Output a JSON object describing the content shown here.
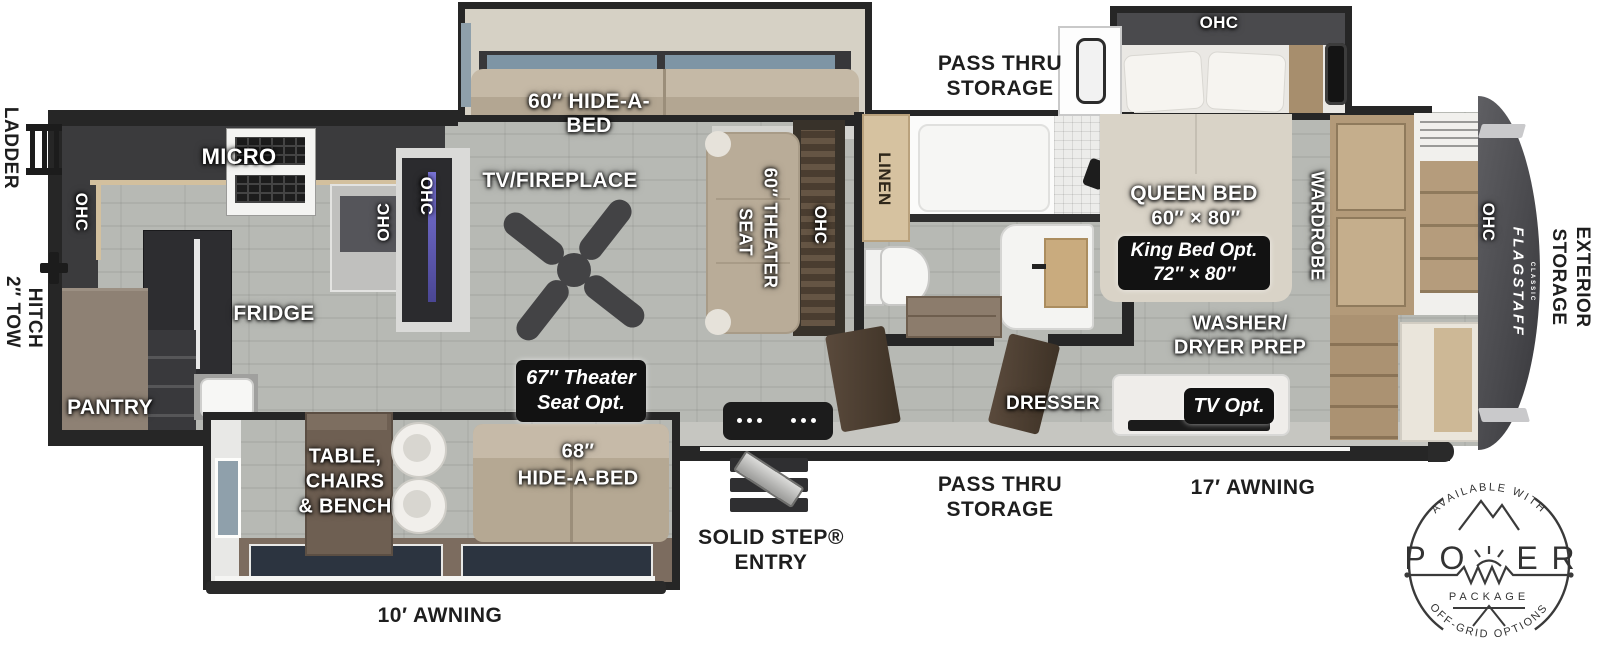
{
  "colors": {
    "wall": "#262626",
    "floor": "#b5b7b2",
    "counter_wood": "#d3c09e",
    "badge_bg": "#121212",
    "front_cap": "#4e4e52",
    "sofa_tan": "#b9ac98",
    "exterior_text": "#1e1e1e"
  },
  "exterior": {
    "ladder": "LADDER",
    "tow_hitch": [
      "2″ TOW",
      "HITCH"
    ],
    "awning_rear": "10′ AWNING",
    "awning_front": "17′ AWNING",
    "solid_step": [
      "SOLID STEP®",
      "ENTRY"
    ],
    "pass_thru_top": [
      "PASS THRU",
      "STORAGE"
    ],
    "pass_thru_bottom": [
      "PASS THRU",
      "STORAGE"
    ],
    "exterior_storage": [
      "EXTERIOR",
      "STORAGE"
    ]
  },
  "interior": {
    "micro": "MICRO",
    "fridge": "FRIDGE",
    "pantry": "PANTRY",
    "tv_fireplace": "TV/FIREPLACE",
    "hide_a_bed_60": [
      "60″ HIDE-A-",
      "BED"
    ],
    "theater_seat": [
      "60″ THEATER",
      "SEAT"
    ],
    "linen": "LINEN",
    "queen_bed": [
      "QUEEN BED",
      "60″ × 80″"
    ],
    "wardrobe": "WARDROBE",
    "washer_dryer": [
      "WASHER/",
      "DRYER PREP"
    ],
    "dresser": "DRESSER",
    "table_chairs": [
      "TABLE,",
      "CHAIRS",
      "& BENCH"
    ],
    "hide_a_bed_68": [
      "68″",
      "HIDE-A-BED"
    ],
    "ohc": "OHC"
  },
  "options": {
    "theater_seat_opt": [
      "67″ Theater",
      "Seat Opt."
    ],
    "king_bed_opt": [
      "King Bed Opt.",
      "72″ × 80″"
    ],
    "tv_opt": "TV Opt."
  },
  "logo": {
    "brand": "FLAGSTAFF",
    "series": "CLASSIC"
  },
  "power_badge": {
    "top": "AVAILABLE WITH",
    "letters": [
      "P",
      "O",
      "E",
      "R"
    ],
    "package": "PACKAGE",
    "bottom": "OFF-GRID OPTIONS"
  }
}
